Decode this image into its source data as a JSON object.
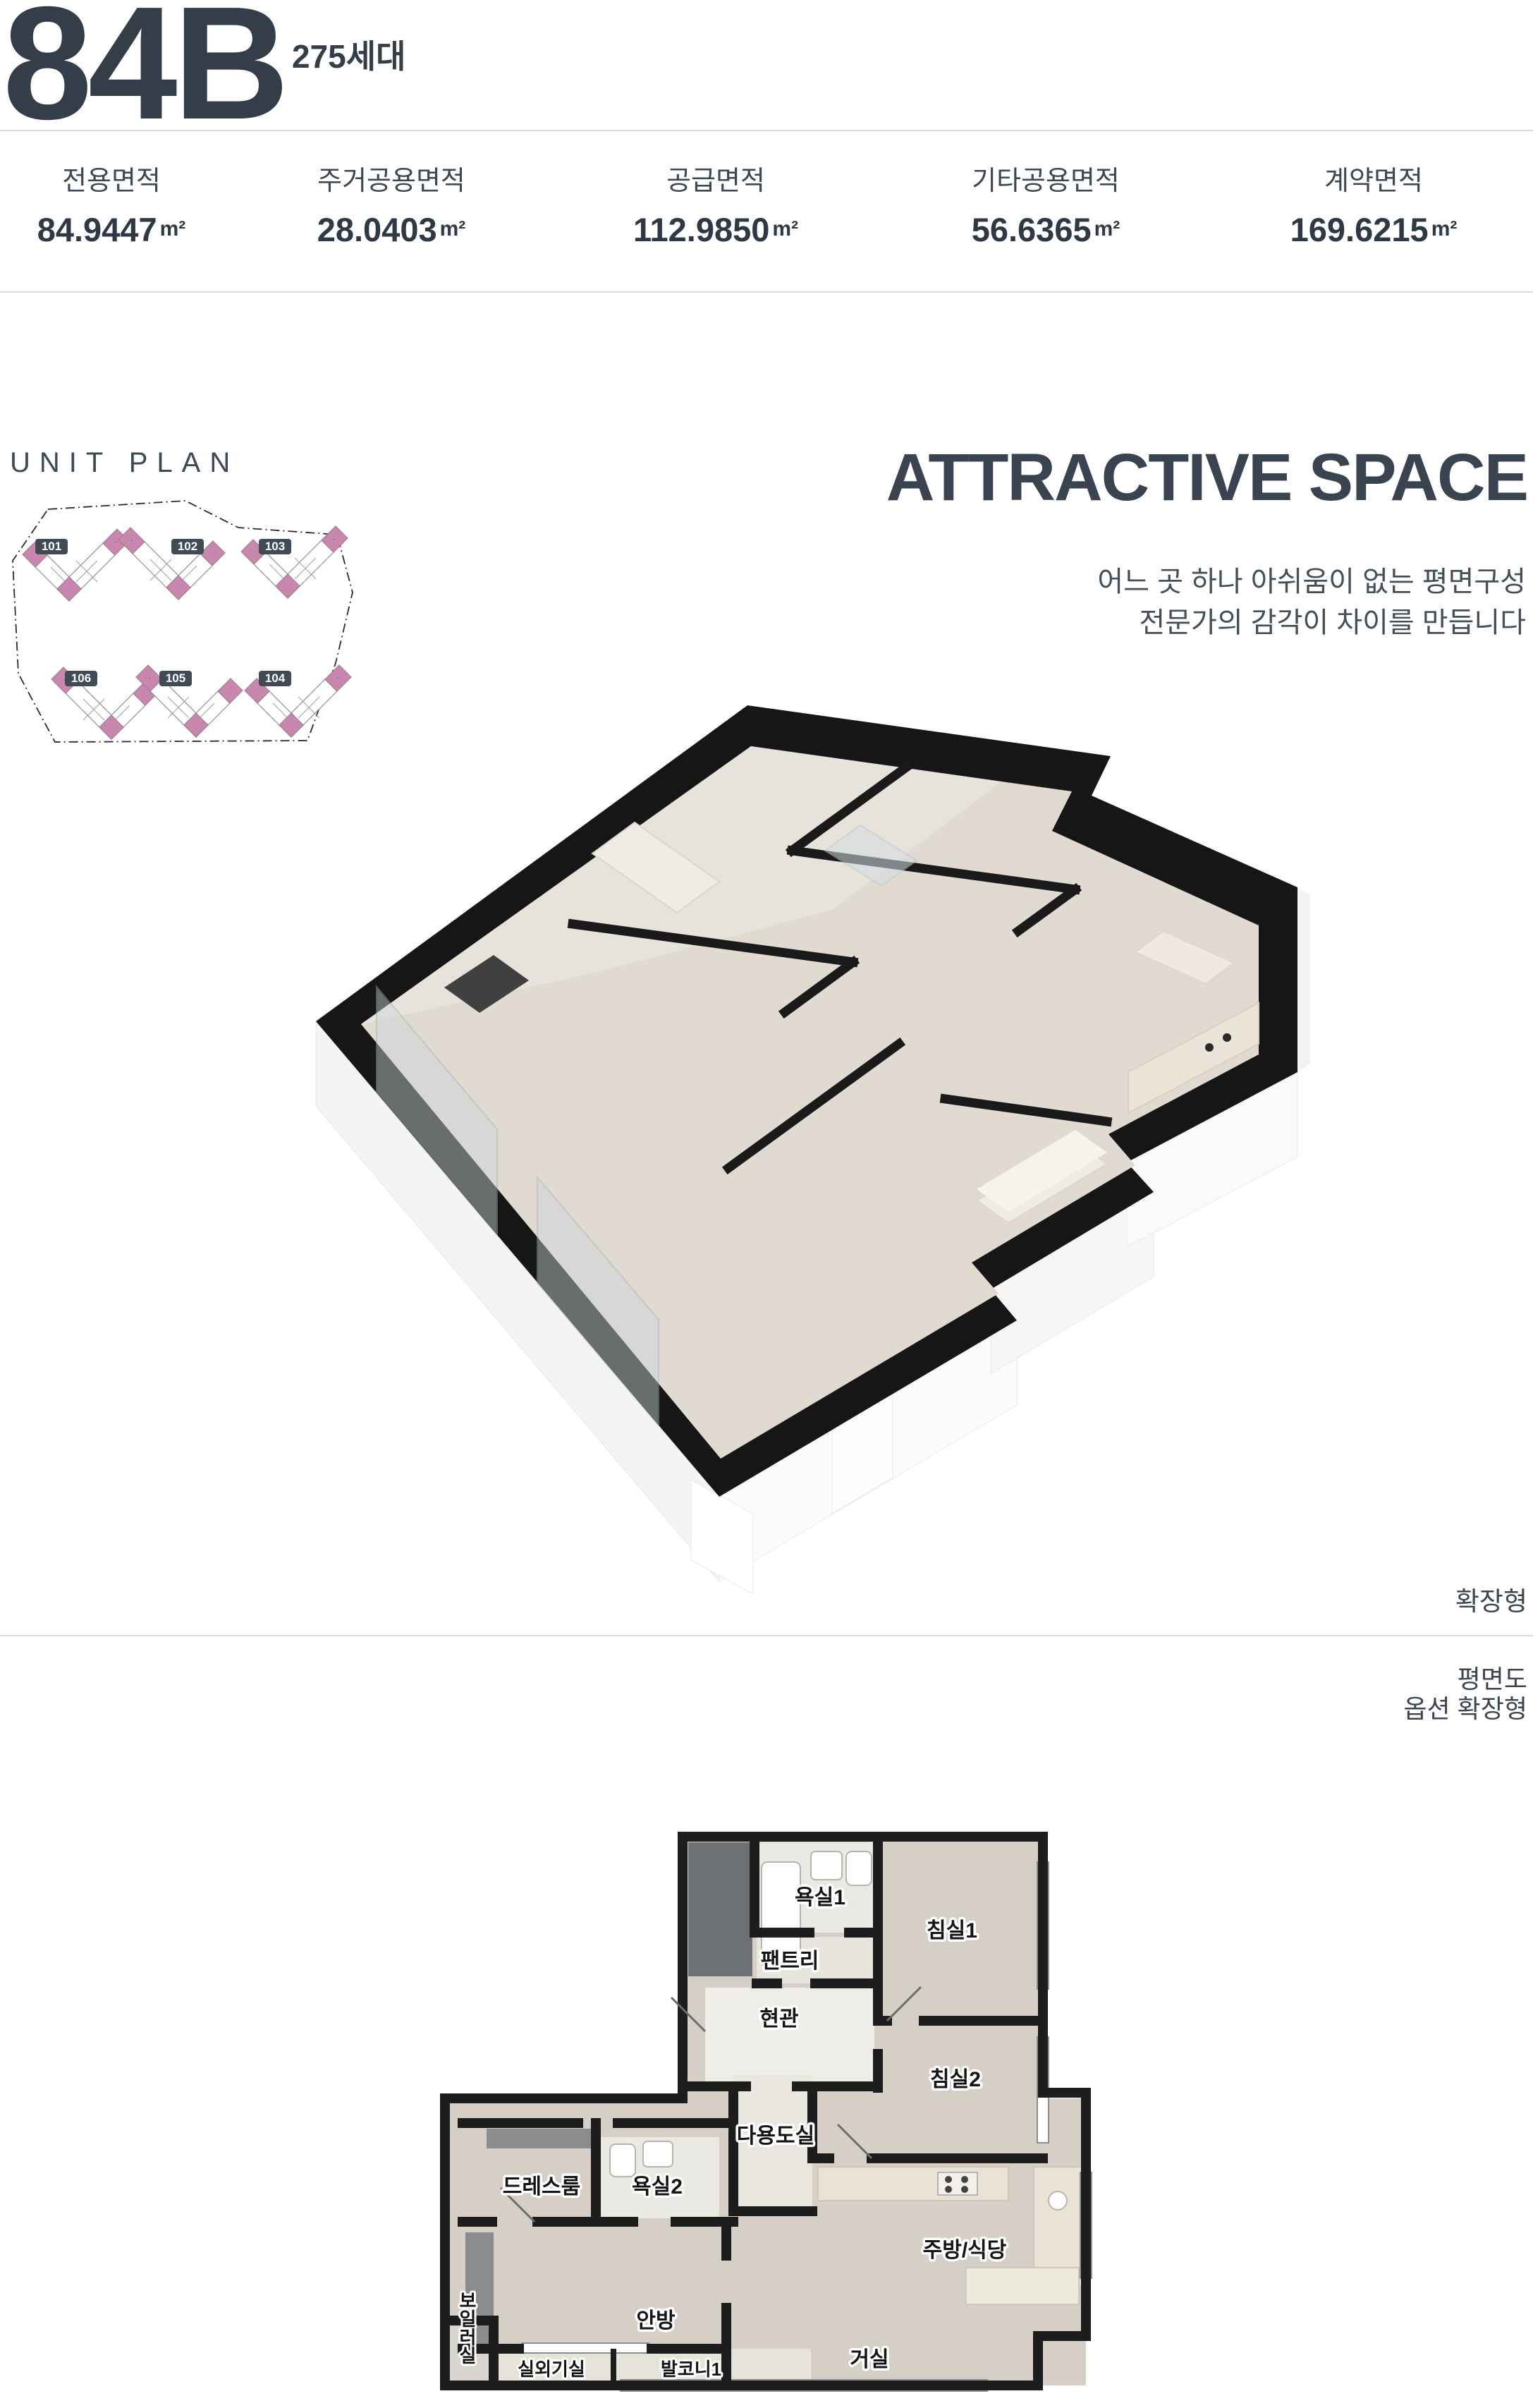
{
  "header": {
    "unit_code": "84B",
    "household_count": "275세대"
  },
  "area_table": {
    "columns": [
      {
        "label": "전용면적",
        "value": "84.9447",
        "unit": "m²"
      },
      {
        "label": "주거공용면적",
        "value": "28.0403",
        "unit": "m²"
      },
      {
        "label": "공급면적",
        "value": "112.9850",
        "unit": "m²"
      },
      {
        "label": "기타공용면적",
        "value": "56.6365",
        "unit": "m²"
      },
      {
        "label": "계약면적",
        "value": "169.6215",
        "unit": "m²"
      }
    ]
  },
  "unit_plan": {
    "title": "UNIT PLAN",
    "buildings": [
      {
        "id": "101"
      },
      {
        "id": "102"
      },
      {
        "id": "103"
      },
      {
        "id": "106"
      },
      {
        "id": "105"
      },
      {
        "id": "104"
      }
    ]
  },
  "attractive": {
    "title": "ATTRACTIVE SPACE",
    "subtitle_line1": "어느 곳 하나 아쉬움이 없는 평면구성",
    "subtitle_line2": "전문가의 감각이 차이를 만듭니다"
  },
  "iso_plan": {
    "caption": "확장형"
  },
  "floor_plan": {
    "caption_line1": "평면도",
    "caption_line2": "옵션 확장형",
    "rooms": [
      {
        "name": "욕실1"
      },
      {
        "name": "침실1"
      },
      {
        "name": "팬트리"
      },
      {
        "name": "현관"
      },
      {
        "name": "침실2"
      },
      {
        "name": "다용도실"
      },
      {
        "name": "드레스룸"
      },
      {
        "name": "욕실2"
      },
      {
        "name": "주방/식당"
      },
      {
        "name": "안방"
      },
      {
        "name": "거실"
      },
      {
        "name": "보일러실"
      },
      {
        "name": "실외기실"
      },
      {
        "name": "발코니1"
      }
    ]
  },
  "colors": {
    "text_dark": "#333e49",
    "divider": "#d9d9d9",
    "site_pink": "#c887ac",
    "badge_bg": "#414b56",
    "wall_black": "#1d1d1d",
    "floor_wood": "#d6cfc6",
    "floor_tile": "#ebe9e3"
  }
}
